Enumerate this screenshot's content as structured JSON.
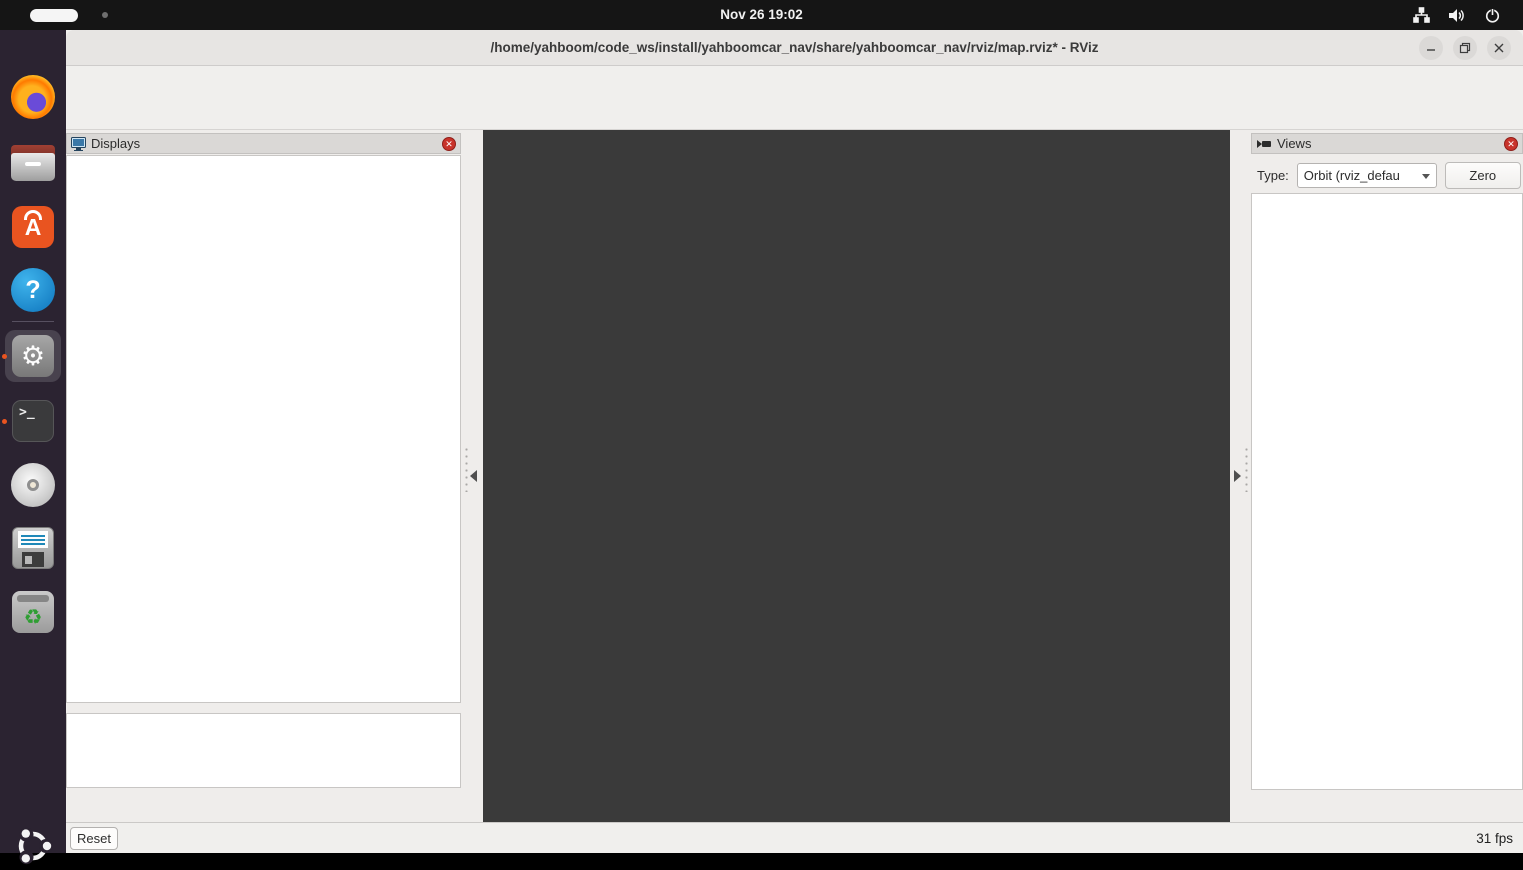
{
  "top_bar": {
    "clock": "Nov 26 19:02",
    "icons": [
      "network-tree-icon",
      "volume-icon",
      "power-icon"
    ]
  },
  "dock": {
    "items": [
      "firefox",
      "files",
      "ubuntu-software",
      "help",
      "settings",
      "terminal",
      "disc-burner",
      "floppy-backup",
      "trash",
      "ubuntu-logo"
    ]
  },
  "window": {
    "title": "/home/yahboom/code_ws/install/yahboomcar_nav/share/yahboomcar_nav/rviz/map.rviz* - RViz",
    "menu": [
      "File",
      "Panels",
      "Help"
    ],
    "toolbar": [
      {
        "label": "Interact",
        "icon": "hand",
        "active": true
      },
      {
        "label": "Move Camera",
        "icon": "move-arrows",
        "active": false
      },
      {
        "label": "Select",
        "icon": "selection-box",
        "active": false
      },
      {
        "label": "Focus Camera",
        "icon": "focus-crosshair",
        "active": false
      },
      {
        "label": "Measure",
        "icon": "ruler",
        "active": false
      },
      {
        "label": "2D Pose Estimate",
        "icon": "green-arrow",
        "active": false
      },
      {
        "label": "2D Goal Pose",
        "icon": "green-arrow",
        "active": false
      },
      {
        "label": "Publish Point",
        "icon": "map-pin",
        "active": false
      },
      {
        "label": "",
        "icon": "plus",
        "active": false
      },
      {
        "label": "",
        "icon": "minus-dropdown",
        "active": false
      }
    ],
    "displays_panel": {
      "title": "Displays",
      "rows": [
        {
          "label": "Global Options",
          "arrow": "down",
          "icon": "gear",
          "value": ""
        },
        {
          "label": "Fixed Frame",
          "indent": 1,
          "value": "map"
        },
        {
          "label": "Background Color",
          "indent": 1,
          "value": "48; 48; 48",
          "swatch": "#303030"
        },
        {
          "label": "Frame Rate",
          "indent": 1,
          "value": "30"
        },
        {
          "label": "Global Status: Ok",
          "arrow": "down",
          "icon": "check",
          "value": ""
        },
        {
          "label": "Fixed Frame",
          "indent": 1,
          "icon": "check",
          "value": "OK"
        },
        {
          "label": "Grid",
          "arrow": "right",
          "icon": "grid",
          "bold": true,
          "check": true
        },
        {
          "label": "RobotModel",
          "arrow": "right",
          "icon": "robot",
          "bold": true,
          "check": true
        },
        {
          "label": "Odometry",
          "arrow": "right",
          "icon": "odometry",
          "bold": false,
          "check": false
        },
        {
          "label": "LaserScan",
          "arrow": "right",
          "icon": "laser",
          "bold": true,
          "check": true
        },
        {
          "label": "Map",
          "arrow": "right",
          "icon": "map",
          "bold": true,
          "check": true
        },
        {
          "label": "TF",
          "arrow": "right",
          "icon": "tf",
          "bold": true,
          "check": true
        }
      ],
      "buttons": [
        {
          "label": "Add",
          "enabled": true
        },
        {
          "label": "Duplicate",
          "enabled": false
        },
        {
          "label": "Remove",
          "enabled": false
        },
        {
          "label": "Rename",
          "enabled": false
        }
      ]
    },
    "views_panel": {
      "title": "Views",
      "type_label": "Type:",
      "type_value": "Orbit (rviz_defau",
      "zero_button": "Zero",
      "rows": [
        {
          "label": "Current View",
          "arrow": "down",
          "bold": true,
          "value": "Orbit (rviz)",
          "value_bold": true
        },
        {
          "label": "Near Clip ...",
          "indent": 1,
          "value": "0.01"
        },
        {
          "label": "Enable Ste...",
          "indent": 1,
          "arrow": "right",
          "check": false
        },
        {
          "label": "Invert Z Axis",
          "indent": 1,
          "check": false
        },
        {
          "label": "Target Fra...",
          "indent": 1,
          "value": "<Fixed Frame>"
        },
        {
          "label": "Distance",
          "indent": 1,
          "value": "5.37927"
        },
        {
          "label": "Focal Shap...",
          "indent": 1,
          "value": "0.05"
        },
        {
          "label": "Focal Shap...",
          "indent": 1,
          "check": true
        },
        {
          "label": "Yaw",
          "indent": 1,
          "value": "3.1604"
        },
        {
          "label": "Pitch",
          "indent": 1,
          "value": "1.5698"
        },
        {
          "label": "Focal Point",
          "indent": 1,
          "arrow": "right",
          "value": "0.69263; -1.3106..."
        }
      ],
      "buttons": [
        {
          "label": "Save",
          "enabled": true
        },
        {
          "label": "Remove",
          "enabled": true
        },
        {
          "label": "Rename",
          "enabled": true
        }
      ]
    },
    "status_bar": {
      "reset": "Reset",
      "hints": [
        {
          "text": "Left-Click:",
          "bold": true
        },
        {
          "text": " Rotate.  ",
          "bold": false
        },
        {
          "text": "Middle-Click:",
          "bold": true
        },
        {
          "text": " Move X/Y.  ",
          "bold": false
        },
        {
          "text": "Right-Click/Mouse Wheel:",
          "bold": true
        },
        {
          "text": " Zoom.  ",
          "bold": false
        },
        {
          "text": "Shift:",
          "bold": true
        },
        {
          "text": " More options.",
          "bold": false
        }
      ],
      "fps": "31 fps"
    },
    "scene": {
      "background": "#3a3a3a",
      "grid_line": "#545454",
      "map_fill": "#cfcfcf",
      "map_grid_line": "#b9b9b9",
      "sage": "#6f7d77",
      "wall": "#0a0a0a",
      "path_line": "#d8d862",
      "tf_red": "#cc1414",
      "tf_green": "#12b812",
      "tf_blue": "#1414cc",
      "tf_magenta": "#e03ca8",
      "laser_palette": {
        "top": [
          "#e89018",
          "#e8c818",
          "#e8e018",
          "#a0e018",
          "#50d820",
          "#38d048",
          "#30d090",
          "#28b8d8",
          "#2880e8",
          "#a028e8",
          "#e020d8",
          "#5828e8",
          "#2070e8",
          "#28c0d0",
          "#40d858",
          "#90e020",
          "#e0d818",
          "#e8b018",
          "#e89018",
          "#c8e018",
          "#e8a018"
        ],
        "right": [
          "#e8c018",
          "#e89018",
          "#e87018",
          "#e8a818",
          "#c8e018",
          "#60d820",
          "#38d048",
          "#28c8b0",
          "#2090e0",
          "#4028e8",
          "#c818e8",
          "#e818c8",
          "#2858e8",
          "#28b8d8",
          "#48d848",
          "#a0e018",
          "#e8d018",
          "#e8a018",
          "#e87018",
          "#e84018",
          "#e82818"
        ],
        "bottom": [
          "#e82818",
          "#e84818",
          "#e87818",
          "#e8a018",
          "#e8c818",
          "#c0e818",
          "#70e020",
          "#38d848",
          "#28c8a8",
          "#2888e0",
          "#3040e8",
          "#2098e0",
          "#30c8c0",
          "#48d848",
          "#98e020",
          "#e0d818",
          "#e8a818",
          "#e87818",
          "#e84018"
        ],
        "left": [
          "#b8e018",
          "#70e018",
          "#48d828",
          "#30d058",
          "#28d0a0",
          "#28a8e0",
          "#2858e8",
          "#28b0d8",
          "#38d080",
          "#48d838",
          "#80e020",
          "#e8a818",
          "#e87818",
          "#e8a018",
          "#e8c818",
          "#e8b018",
          "#e88018",
          "#e84818",
          "#e82818"
        ]
      }
    }
  }
}
